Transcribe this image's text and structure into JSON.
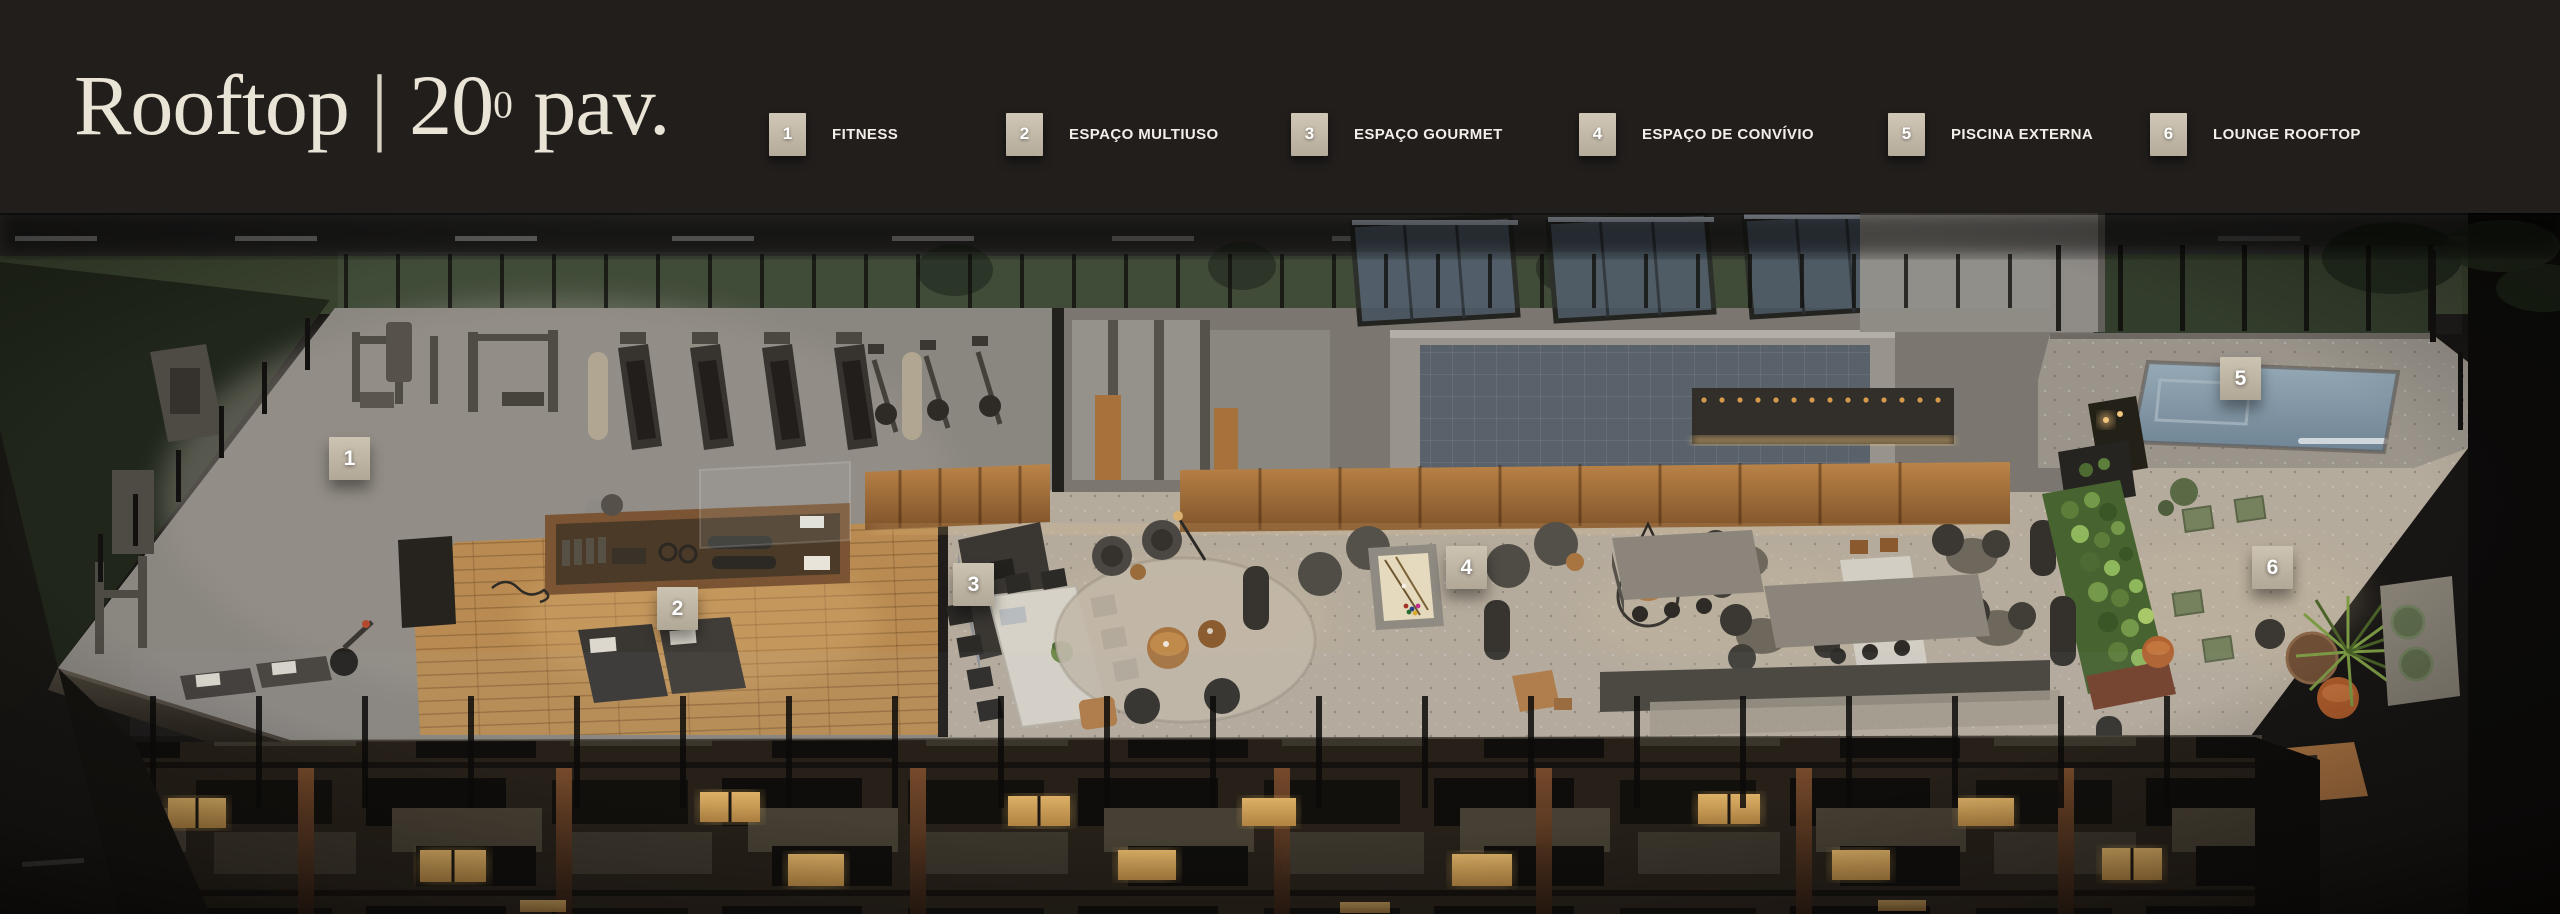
{
  "header": {
    "title": {
      "project": "Rooftop",
      "separator": "|",
      "floor_number": "20",
      "floor_ordinal": "0",
      "floor_suffix": "pav."
    },
    "legend": [
      {
        "number": "1",
        "label": "FITNESS"
      },
      {
        "number": "2",
        "label": "ESPAÇO MULTIUSO"
      },
      {
        "number": "3",
        "label": "ESPAÇO GOURMET"
      },
      {
        "number": "4",
        "label": "ESPAÇO DE CONVÍVIO"
      },
      {
        "number": "5",
        "label": "PISCINA EXTERNA"
      },
      {
        "number": "6",
        "label": "LOUNGE ROOFTOP"
      }
    ]
  },
  "plan": {
    "markers": [
      {
        "number": "1"
      },
      {
        "number": "2"
      },
      {
        "number": "3"
      },
      {
        "number": "4"
      },
      {
        "number": "5"
      },
      {
        "number": "6"
      }
    ]
  },
  "colors": {
    "header_bg": "#211e1c",
    "title_text": "#eae4d6",
    "legend_badge": "#c5bcac",
    "marker_badge": "#c2b9a8",
    "wood_floor": "#c09058",
    "fitness_floor": "#8a8680",
    "stone_floor": "#b5ab9c",
    "pool_water": "#8297a6",
    "grass": "#3b442e",
    "lit_window": "#d2a55e"
  }
}
